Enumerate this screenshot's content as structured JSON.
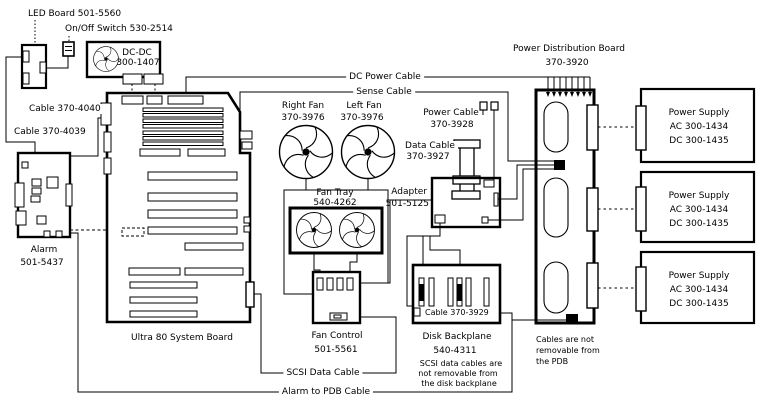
{
  "diagram_type": "hardware-cabling-diagram",
  "colors": {
    "line": "#000000",
    "background": "#ffffff"
  },
  "labels": {
    "led_board": "LED Board 501-5560",
    "onoff_switch": "On/Off Switch 530-2514",
    "dcdc_line1": "DC-DC",
    "dcdc_line2": "300-1407",
    "cable_4040": "Cable 370-4040",
    "cable_4039": "Cable 370-4039",
    "alarm_line1": "Alarm",
    "alarm_line2": "501-5437",
    "system_board": "Ultra 80 System Board",
    "dc_power_cable": "DC Power Cable",
    "sense_cable": "Sense Cable",
    "right_fan_line1": "Right Fan",
    "right_fan_line2": "370-3976",
    "left_fan_line1": "Left Fan",
    "left_fan_line2": "370-3976",
    "fan_tray_line1": "Fan Tray",
    "fan_tray_line2": "540-4262",
    "power_cable_line1": "Power Cable",
    "power_cable_line2": "370-3928",
    "data_cable_line1": "Data Cable",
    "data_cable_line2": "370-3927",
    "adapter_line1": "Adapter",
    "adapter_line2": "501-5125",
    "pdb_line1": "Power Distribution Board",
    "pdb_line2": "370-3920",
    "fan_control_line1": "Fan Control",
    "fan_control_line2": "501-5561",
    "disk_backplane_line1": "Disk  Backplane",
    "disk_backplane_line2": "540-4311",
    "backplane_note_line1": "SCSI data cables are",
    "backplane_note_line2": "not removable from",
    "backplane_note_line3": "the disk backplane",
    "cable_3929": "Cable 370-3929",
    "scsi_data_cable": "SCSI Data Cable",
    "alarm_pdb_cable": "Alarm to PDB Cable",
    "pdb_note_line1": "Cables are not",
    "pdb_note_line2": "removable from",
    "pdb_note_line3": "the PDB",
    "power_supply_line1": "Power  Supply",
    "power_supply_line2": "AC 300-1434",
    "power_supply_line3": "DC 300-1435"
  }
}
